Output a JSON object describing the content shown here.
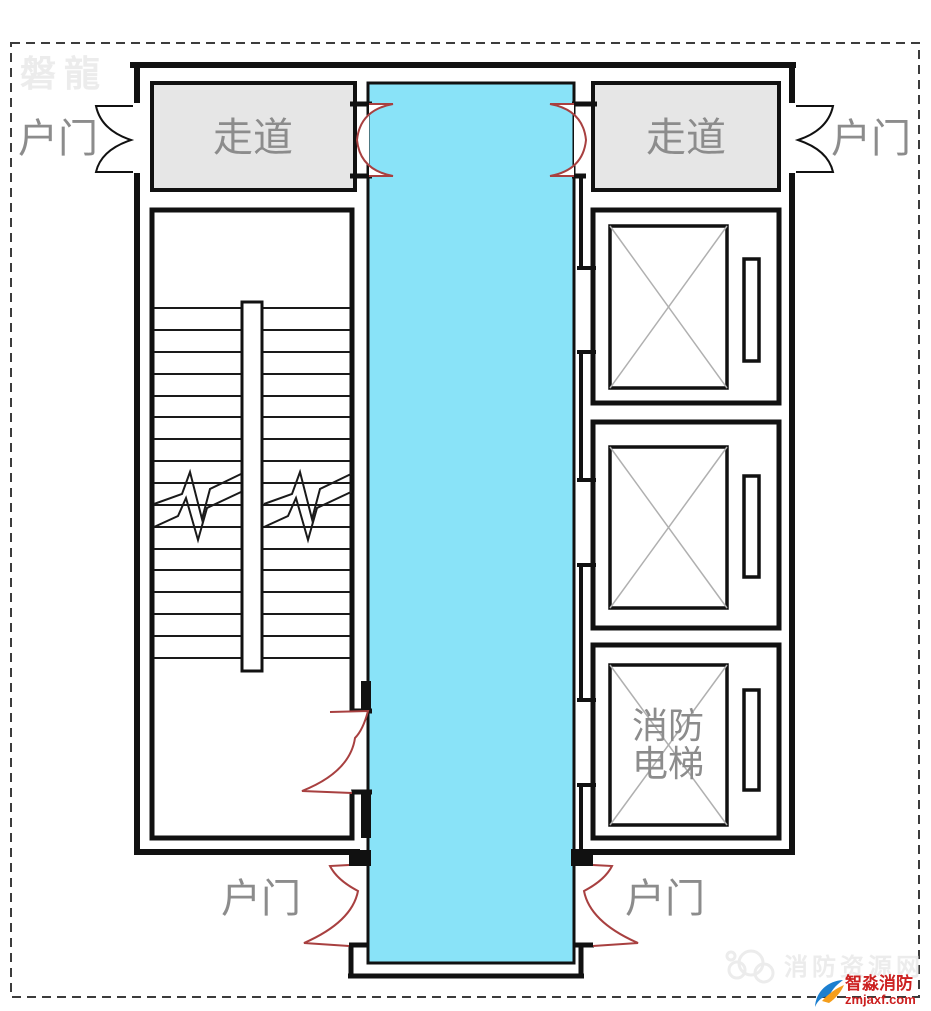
{
  "plan": {
    "watermark_top": "磐龍",
    "corridor_left": "走道",
    "corridor_right": "走道",
    "door_top_left": "户门",
    "door_top_right": "户门",
    "door_bottom_left": "户门",
    "door_bottom_right": "户门",
    "fire_elevator": {
      "line1": "消防",
      "line2": "电梯"
    },
    "colors": {
      "lobby_cyan": "#89e3f8",
      "corridor_gray": "#e6e6e6",
      "door_red": "#a84040",
      "wall_black": "#111111",
      "label_gray": "#8c8c8c",
      "watermark_gray": "#ececec",
      "logo_red": "#cc2020",
      "logo_blue": "#1b7fd0",
      "logo_orange": "#f59e1b"
    },
    "footer": {
      "watermark": "消防资源网",
      "logo_text": "智淼消防",
      "logo_domain": "zmjaxf.com"
    }
  }
}
